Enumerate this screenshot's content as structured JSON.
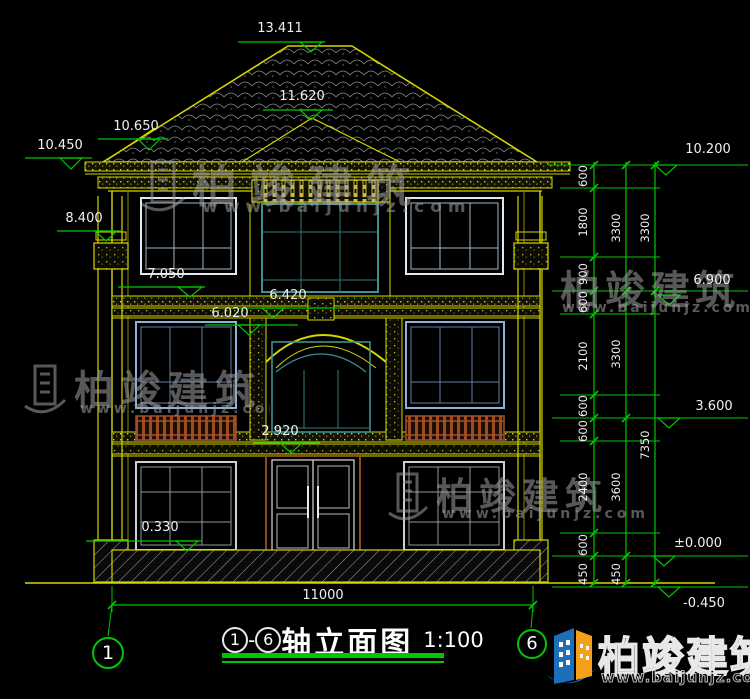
{
  "title_block": {
    "axis_start": "1",
    "separator": "-",
    "axis_end": "6",
    "name": "轴立面图",
    "scale": "1:100"
  },
  "axes": {
    "left": "1",
    "right": "6"
  },
  "elevations": {
    "ridge": "13.411",
    "porch_ridge": "11.620",
    "eave_top_left": "10.650",
    "eave_left": "10.450",
    "eave_right": "10.200",
    "capital": "8.400",
    "f3_sill": "7.050",
    "f3_floor_right": "6.900",
    "band_mid": "6.420",
    "f2_head": "6.020",
    "f2_floor_right": "3.600",
    "door_head": "2.920",
    "f1_sill": "0.330",
    "ground": "±0.000",
    "site": "-0.450"
  },
  "v_dims": {
    "chain_inner": [
      "600",
      "1800",
      "900",
      "600",
      "2100",
      "600",
      "600",
      "2400",
      "600",
      "450"
    ],
    "chain_mid": [
      "3300",
      "3300",
      "3600",
      "450"
    ],
    "chain_outer": [
      "3300",
      "7350"
    ]
  },
  "h_dims": {
    "overall_width": "11000"
  },
  "watermark": {
    "brand": "柏竣建筑",
    "url": "www.baijunjz.com"
  },
  "logo": {
    "brand": "柏竣建筑",
    "url": "www.baijunjz.com"
  },
  "colors": {
    "background": "#000000",
    "line_yellow": "#d6d600",
    "dim_green": "#00c800",
    "text_white": "#f0f0f0",
    "window_blue": "#8fb0d8",
    "window_teal": "#2e8b8b",
    "railing_brown": "#9c4a1f",
    "step_blue": "#2f2fd0",
    "logo_blue": "#1d6fba",
    "logo_orange": "#f5a01a"
  }
}
